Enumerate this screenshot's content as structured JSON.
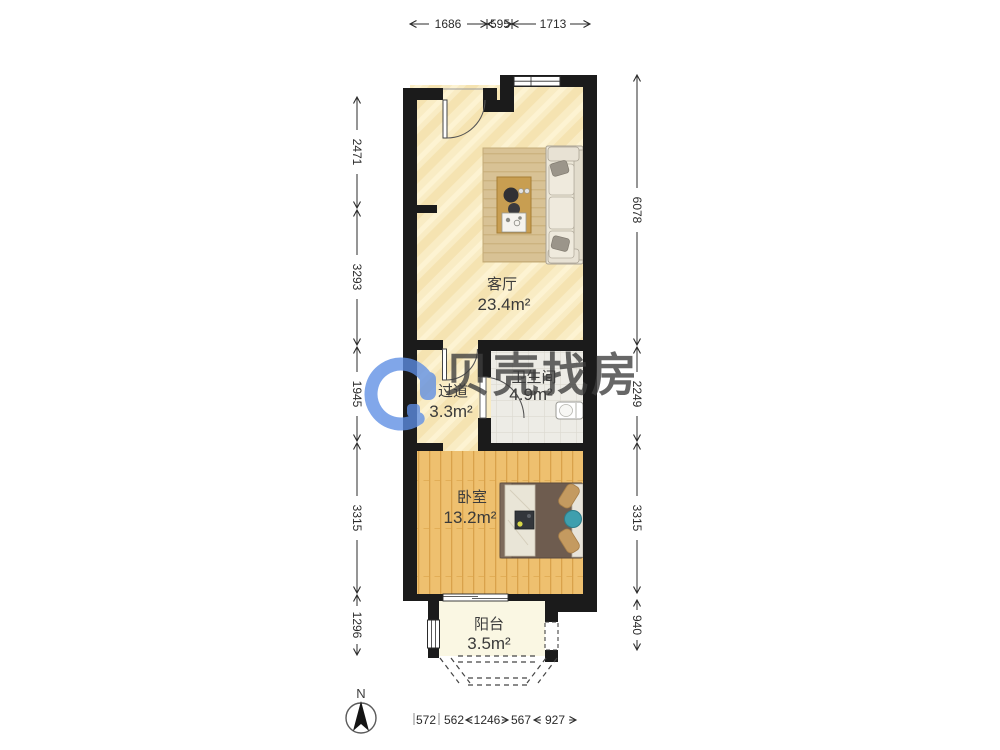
{
  "watermark": {
    "brand": "贝壳找房",
    "color": "#5d8ee4"
  },
  "compass": {
    "north_label": "N"
  },
  "rooms": [
    {
      "name": "客厅",
      "area": "23.4m²"
    },
    {
      "name": "过道",
      "area": "3.3m²"
    },
    {
      "name": "卫生间",
      "area": "4.9m²"
    },
    {
      "name": "卧室",
      "area": "13.2m²"
    },
    {
      "name": "阳台",
      "area": "3.5m²"
    }
  ],
  "dimensions": {
    "top": [
      "1686",
      "595",
      "1713"
    ],
    "left": [
      "2471",
      "3293",
      "1945",
      "3315",
      "1296"
    ],
    "right": [
      "6078",
      "2249",
      "3315",
      "940"
    ],
    "bottom": [
      "572",
      "562",
      "1246",
      "567",
      "927"
    ]
  },
  "colors": {
    "wall": "#1b1b1b",
    "living_floor": "#f9ecc4",
    "bedroom_floor": "#eec06f",
    "bathroom_floor": "#edece6",
    "balcony_floor": "#faf7e3",
    "rug": "#d8c295",
    "coffee_table": "#c89e51",
    "sofa": "#ece7d8",
    "bed_frame": "#6e5c4f",
    "pillow": "#c49a60",
    "accent_teal": "#3f9fae",
    "watermark_blue": "#5d8ee4",
    "dimension_text": "#2b2b2b"
  }
}
